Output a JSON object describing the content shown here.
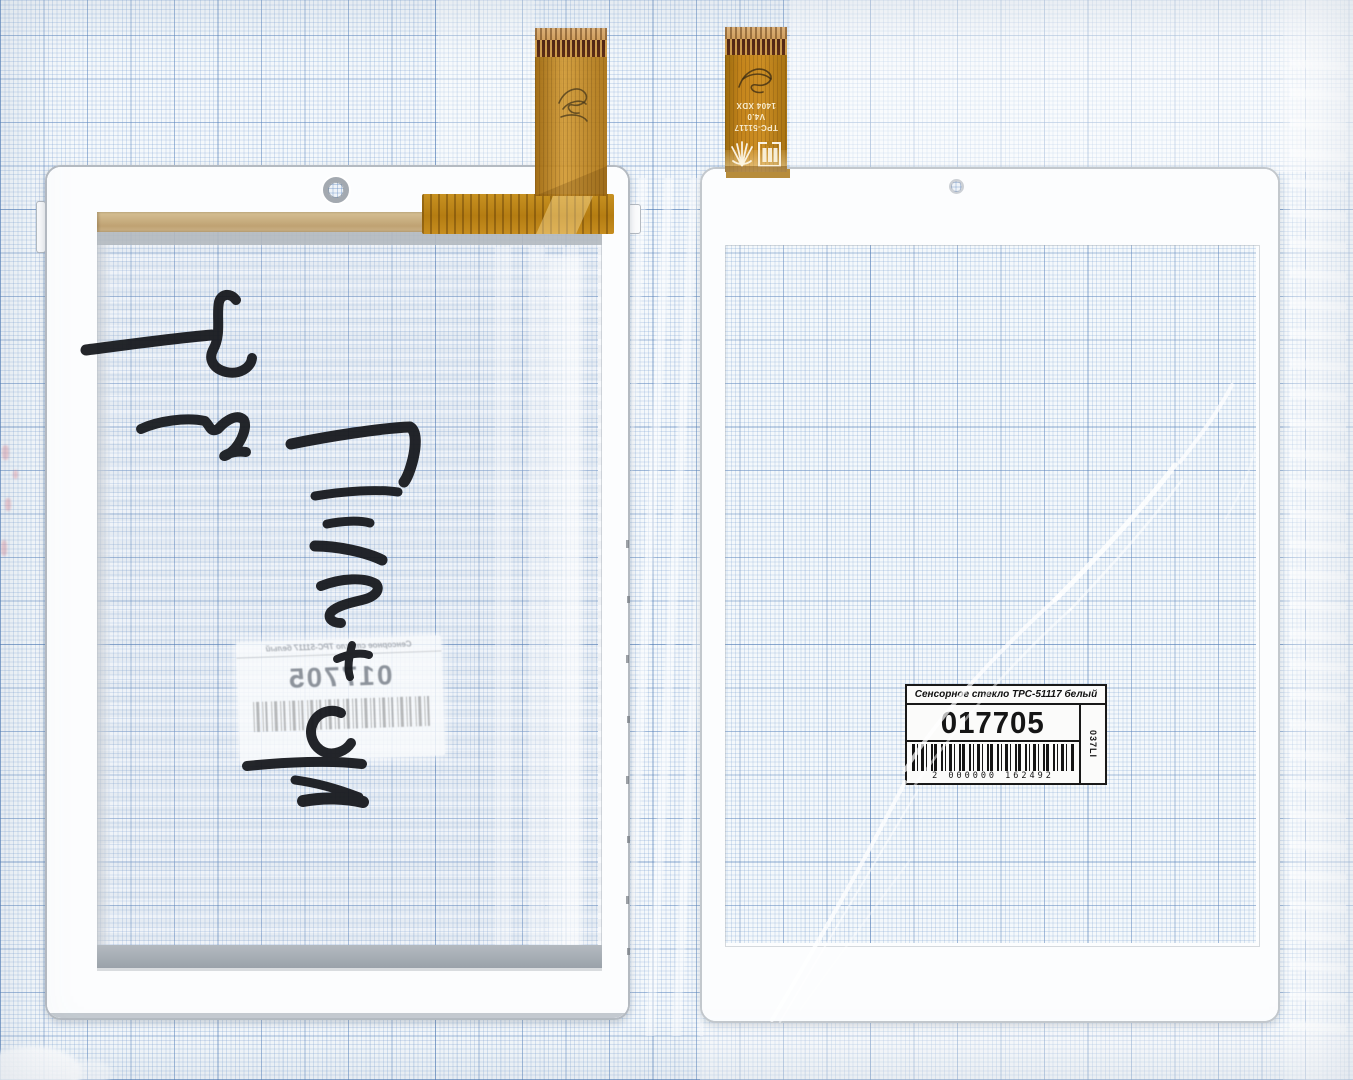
{
  "scene": {
    "subject": "touchscreen digitizer panels on millimeter graph paper",
    "paper_color": "#f4f8fb",
    "grid_minor_color": "#c8d9ec",
    "grid_major_color": "#9bb9dd"
  },
  "label": {
    "title": "Сенсорное стекло TPC-51117 белый",
    "number": "017705",
    "side_code": "037LI",
    "barcode_digits": "2 000000 162492"
  },
  "left_panel": {
    "mirrored_label": {
      "title": "Сенсорное стекло TPC-51117 белый",
      "number": "017705"
    }
  },
  "right_cable": {
    "model": "TPC-51117 V4.0",
    "date_code": "1404 XDX"
  },
  "colors": {
    "flex_gold": "#c5851c",
    "stiffener_brown": "#542712",
    "marker_ink": "#16181d",
    "frame_white": "#fcfdfe",
    "adhesive_tan": "#c9ae83",
    "adhesive_gray": "#aab1b8",
    "label_ink": "#191919"
  }
}
